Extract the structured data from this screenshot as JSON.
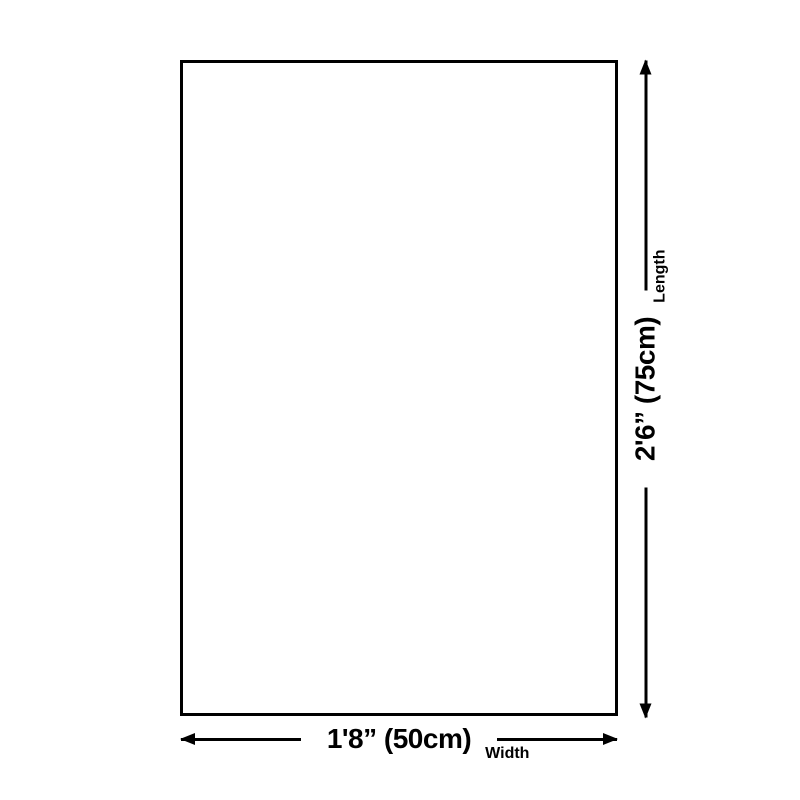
{
  "diagram": {
    "type": "product-dimension-diagram",
    "colors": {
      "stroke": "#000000",
      "background": "#ffffff"
    },
    "icons": {
      "width_arrow": "double-headed-horizontal-arrow-icon",
      "length_arrow": "double-headed-vertical-arrow-icon"
    },
    "width_dimension": {
      "value": "1'8” (50cm)",
      "label": "Width"
    },
    "length_dimension": {
      "value": "2'6” (75cm)",
      "label": "Length"
    }
  }
}
